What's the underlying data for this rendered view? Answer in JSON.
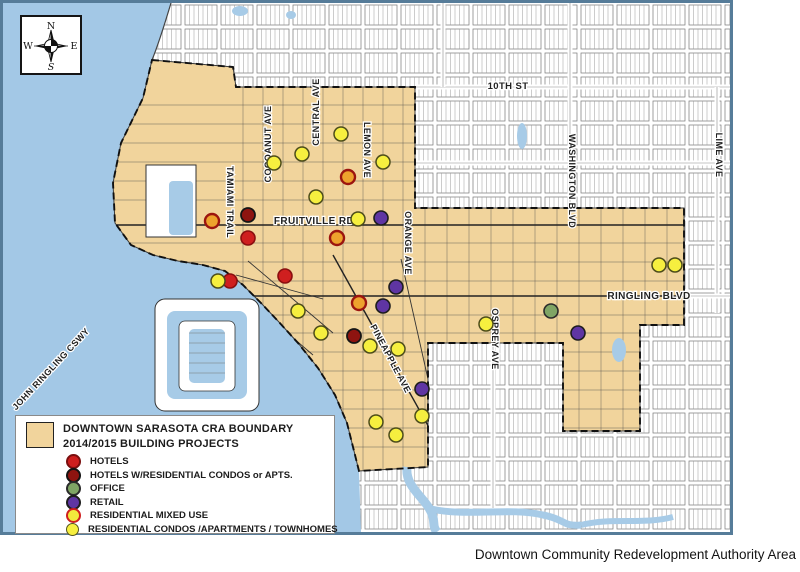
{
  "page": {
    "caption": "Downtown Community Redevelopment Authority Area"
  },
  "map": {
    "colors": {
      "water": "#a7cbe7",
      "cra_fill": "#f1d49c",
      "land": "#ffffff",
      "map_border": "#567c99",
      "boundary_line": "#101010"
    },
    "compass": {
      "north": "N",
      "south": "S",
      "east": "E",
      "west": "W"
    },
    "street_labels": [
      {
        "text": "COCOANUT AVE",
        "x": 268,
        "y": 141,
        "rot": -90,
        "size": 9
      },
      {
        "text": "CENTRAL AVE",
        "x": 316,
        "y": 109,
        "rot": -90,
        "size": 9
      },
      {
        "text": "LEMON AVE",
        "x": 361,
        "y": 147,
        "rot": 90,
        "size": 9
      },
      {
        "text": "TAMIAMI TRAIL",
        "x": 224,
        "y": 199,
        "rot": 90,
        "size": 9
      },
      {
        "text": "FRUITVILLE RD",
        "x": 311,
        "y": 221,
        "rot": 0,
        "size": 10
      },
      {
        "text": "ORANGE AVE",
        "x": 402,
        "y": 240,
        "rot": 90,
        "size": 9
      },
      {
        "text": "10TH ST",
        "x": 505,
        "y": 86,
        "rot": 0,
        "size": 9.5
      },
      {
        "text": "WASHINGTON BLVD",
        "x": 566,
        "y": 178,
        "rot": 90,
        "size": 9
      },
      {
        "text": "LIME AVE",
        "x": 713,
        "y": 152,
        "rot": 90,
        "size": 9
      },
      {
        "text": "RINGLING BLVD",
        "x": 646,
        "y": 296,
        "rot": 0,
        "size": 10
      },
      {
        "text": "OSPREY AVE",
        "x": 489,
        "y": 336,
        "rot": 90,
        "size": 9
      },
      {
        "text": "PINEAPPLE AVE",
        "x": 385,
        "y": 357,
        "rot": 62,
        "size": 9
      },
      {
        "text": "JOHN RINGLING CSWY",
        "x": 50,
        "y": 368,
        "rot": -47,
        "size": 9
      }
    ],
    "legend": {
      "title_line1": "DOWNTOWN SARASOTA CRA BOUNDARY",
      "title_line2": "2014/2015  BUILDING PROJECTS",
      "items": [
        {
          "label": "HOTELS",
          "fill": "#cf1f1f",
          "ring": "#7a0f0f",
          "ring_width": 2
        },
        {
          "label": "HOTELS W/RESIDENTIAL CONDOS or APTS.",
          "fill": "#8e1410",
          "ring": "#131313",
          "ring_width": 2
        },
        {
          "label": "OFFICE",
          "fill": "#7fa565",
          "ring": "#2b2b2b",
          "ring_width": 2
        },
        {
          "label": "RETAIL",
          "fill": "#5f35a3",
          "ring": "#1d1d1d",
          "ring_width": 2
        },
        {
          "label": "RESIDENTIAL MIXED USE",
          "fill": "#f2e93c",
          "ring": "#cf1f1f",
          "ring_width": 2
        },
        {
          "label": "RESIDENTIAL CONDOS /APARTMENTS / TOWNHOMES",
          "fill": "#f6ef3f",
          "ring": "#55551e",
          "ring_width": 1.5
        }
      ]
    },
    "marker_styles": {
      "hotels": {
        "fill": "#cf1f1f",
        "ring": "#8a0f0f",
        "rw": 1.6
      },
      "hotels_residential": {
        "fill": "#8e1410",
        "ring": "#151515",
        "rw": 1.8
      },
      "office": {
        "fill": "#7fa565",
        "ring": "#2b2b2b",
        "rw": 1.6
      },
      "retail": {
        "fill": "#5f35a3",
        "ring": "#1d1d1d",
        "rw": 1.6
      },
      "residential_mixed_use": {
        "fill": "#eda22d",
        "ring": "#9c150f",
        "rw": 2.4
      },
      "residential_condos": {
        "fill": "#f6ef3f",
        "ring": "#4c4c1a",
        "rw": 1.5
      }
    },
    "markers": {
      "hotels": [
        [
          245,
          235
        ],
        [
          282,
          273
        ],
        [
          227,
          278
        ]
      ],
      "hotels_residential": [
        [
          245,
          212
        ],
        [
          351,
          333
        ]
      ],
      "office": [
        [
          548,
          308
        ]
      ],
      "retail": [
        [
          378,
          215
        ],
        [
          393,
          284
        ],
        [
          380,
          303
        ],
        [
          575,
          330
        ],
        [
          419,
          386
        ]
      ],
      "residential_mixed_use": [
        [
          209,
          218
        ],
        [
          345,
          174
        ],
        [
          334,
          235
        ],
        [
          356,
          300
        ]
      ],
      "residential_condos": [
        [
          271,
          160
        ],
        [
          299,
          151
        ],
        [
          338,
          131
        ],
        [
          380,
          159
        ],
        [
          313,
          194
        ],
        [
          355,
          216
        ],
        [
          215,
          278
        ],
        [
          295,
          308
        ],
        [
          318,
          330
        ],
        [
          367,
          343
        ],
        [
          395,
          346
        ],
        [
          483,
          321
        ],
        [
          656,
          262
        ],
        [
          672,
          262
        ],
        [
          373,
          419
        ],
        [
          419,
          413
        ],
        [
          393,
          432
        ]
      ]
    }
  }
}
